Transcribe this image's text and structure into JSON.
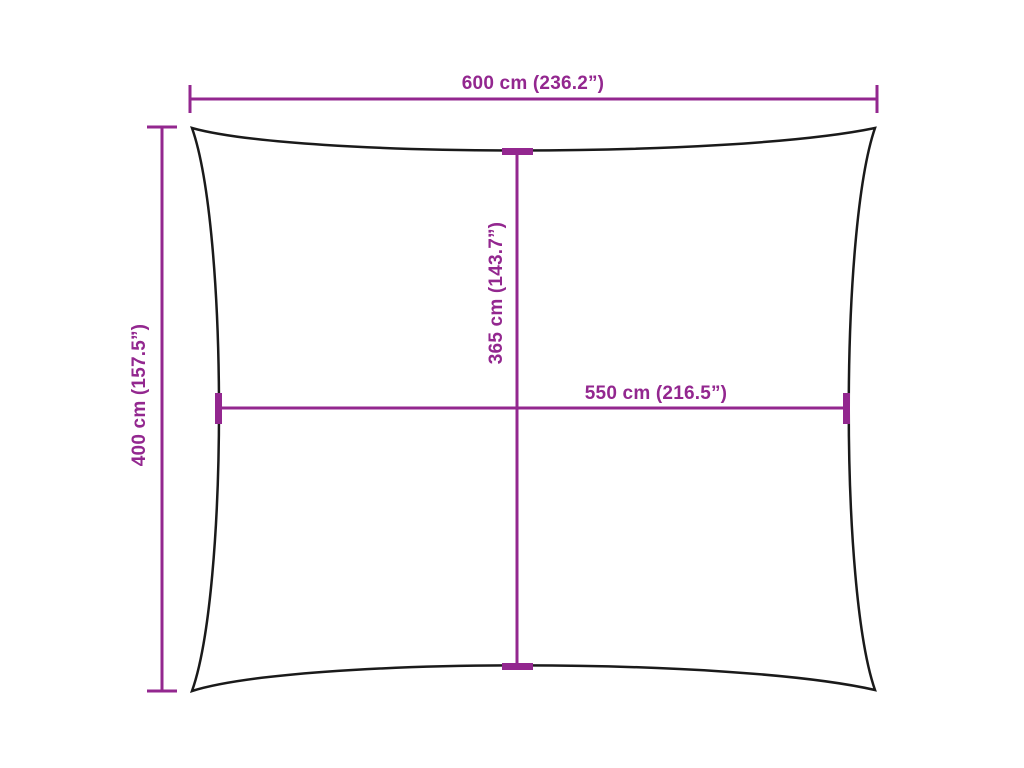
{
  "diagram": {
    "title": "shade-sail-dimension-diagram",
    "shape": "rectangular sail outline with concave edges and pointed corners",
    "colors": {
      "dimension_accent": "#93278F",
      "outline": "#1A1A1A",
      "background": "#FFFFFF"
    },
    "dimensions": {
      "outer_width": {
        "label": "600 cm (236.2”)",
        "position": "top-horizontal"
      },
      "outer_height": {
        "label": "400 cm (157.5”)",
        "position": "left-vertical"
      },
      "inner_height": {
        "label": "365 cm (143.7”)",
        "position": "center-vertical"
      },
      "inner_width": {
        "label": "550 cm (216.5”)",
        "position": "center-horizontal"
      }
    }
  }
}
